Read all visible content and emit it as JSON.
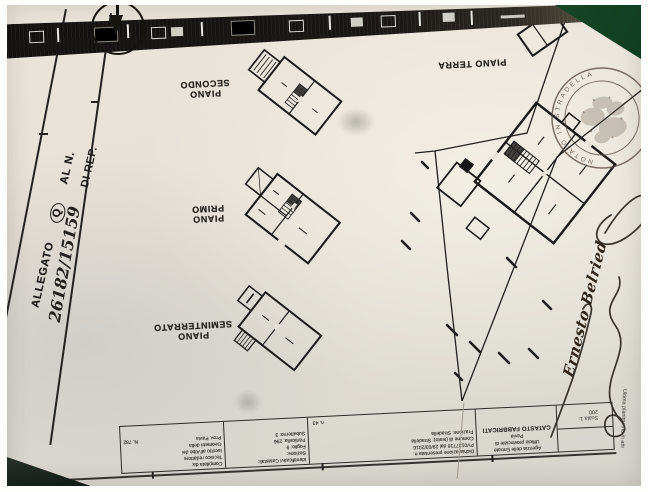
{
  "photo": {
    "table_color": "#1c5a31",
    "paper_color": "#e7e2d8"
  },
  "doc": {
    "side_stamp": {
      "word": "ALLEGATO",
      "circled_letter": "Q",
      "al_n": "AL N.",
      "number": "26182/15159",
      "di_rep": "DI REP."
    },
    "floor_labels": {
      "secondo": "PIANO SECONDO",
      "primo": "PIANO PRIMO",
      "seminterrato": "PIANO SEMINTERRATO",
      "terra": "PIANO TERRA"
    },
    "notary_stamp": {
      "rim_text": "NOTAIO IN STRADELLA"
    },
    "signature": {
      "name": "Ernesto Belried"
    },
    "title_block": {
      "compilata": {
        "l1": "Compilata da:",
        "l2": "Tecnico redattore",
        "l3": "Iscritto all'Albo dei",
        "l4": "Geometri della",
        "l5": "Prov. Pavia",
        "albo_n": "N. 782"
      },
      "identificativi": {
        "title": "Identificativi Catastali:",
        "rows": [
          "Sezione:",
          "Foglio: 9",
          "Particella: 296",
          "Subalterno: 3"
        ]
      },
      "dichiarazione": {
        "l1": "Dichiarazione presentata n.",
        "l2": "PV0137716 dal 29/03/2016",
        "l3": "Comune di (testo): Stradella",
        "l4": "Frazione: Stradella",
        "numero": "n. 43"
      },
      "agenzia": {
        "l1": "Agenzia delle Entrate",
        "l2": "Ufficio provinciale di",
        "l3": "Pavia",
        "l4": "CATASTO FABBRICATI"
      },
      "scala": "Scala 1: 200"
    },
    "margin": {
      "ultima": "Ultima planimetria in atti",
      "data_line": "Data: 23/03/2016 - n. T304365 - Richiedente: TNLFLA67R25G891P"
    }
  }
}
